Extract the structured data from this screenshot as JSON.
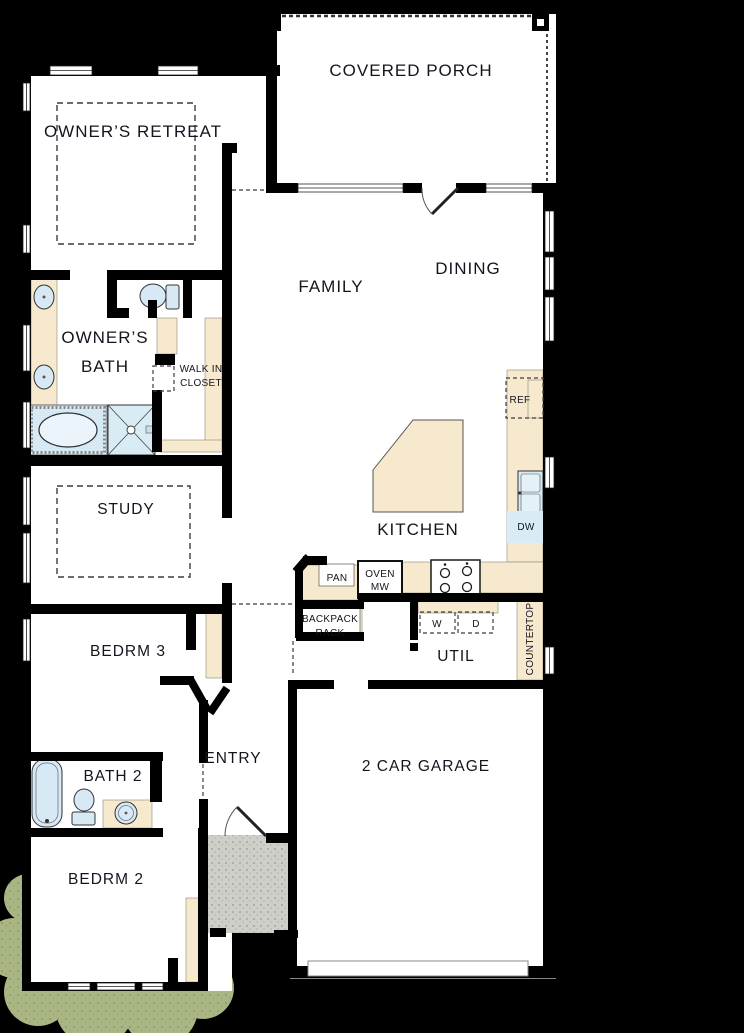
{
  "plan": {
    "colors": {
      "background": "#000000",
      "wall": "#000000",
      "floor": "#ffffff",
      "cabinetry_tan": "#f7e9cd",
      "fixture_blue": "#d6e9f4",
      "shrub_green": "#a9b583",
      "stoop_gray": "#cfcfca",
      "label_text": "#14141f"
    },
    "rooms": {
      "covered_porch": "COVERED PORCH",
      "owners_retreat": "OWNER’S RETREAT",
      "family": "FAMILY",
      "dining": "DINING",
      "owners_bath_line1": "OWNER’S",
      "owners_bath_line2": "BATH",
      "walk_in_closet_line1": "WALK IN",
      "walk_in_closet_line2": "CLOSET",
      "study": "STUDY",
      "kitchen": "KITCHEN",
      "bedroom3": "BEDRM 3",
      "utility": "UTIL",
      "entry": "ENTRY",
      "garage": "2 CAR GARAGE",
      "bath2": "BATH 2",
      "bedroom2": "BEDRM 2"
    },
    "fixtures": {
      "pantry": "PAN",
      "oven_line1": "OVEN",
      "oven_line2": "MW",
      "refrigerator": "REF",
      "dishwasher": "DW",
      "washer": "W",
      "dryer": "D",
      "backpack_rack_line1": "BACKPACK",
      "backpack_rack_line2": "RACK",
      "countertop": "COUNTERTOP"
    }
  }
}
